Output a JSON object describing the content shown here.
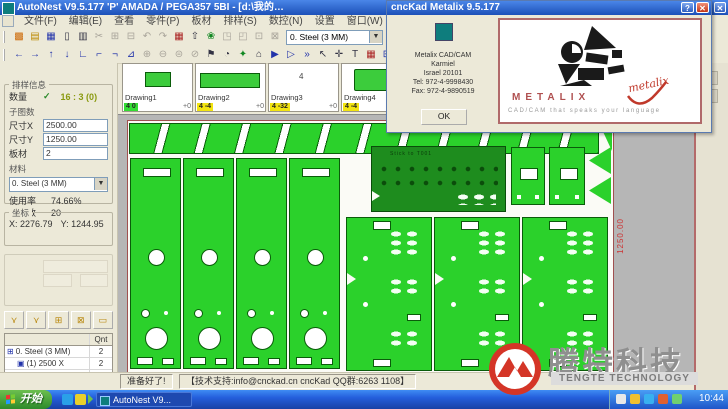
{
  "titlebar": {
    "title": "AutoNest V9.5.177   'P'   AMADA / PEGA357   5BI    - [d:\\我的…",
    "help_btn": "?",
    "close_btn": "✕"
  },
  "menu": {
    "items": [
      "文件(F)",
      "编辑(E)",
      "查看",
      "零件(P)",
      "板材",
      "排样(S)",
      "数控(N)",
      "设置",
      "窗口(W)",
      "帮助(H)"
    ]
  },
  "toolbar1": {
    "icons_a": [
      {
        "g": "▩",
        "c": "or"
      },
      {
        "g": "▤",
        "c": "ye"
      },
      {
        "g": "▦",
        "c": "bl"
      },
      {
        "g": "▯",
        "c": "dk"
      },
      {
        "g": "▥",
        "c": "dk"
      },
      {
        "g": "✂",
        "c": "off"
      },
      {
        "g": "⊞",
        "c": "off"
      },
      {
        "g": "⊟",
        "c": "off"
      },
      {
        "g": "↶",
        "c": "off"
      },
      {
        "g": "↷",
        "c": "off"
      },
      {
        "g": "▦",
        "c": "rd"
      },
      {
        "g": "⇧",
        "c": "dk"
      },
      {
        "g": "❀",
        "c": "gn"
      },
      {
        "g": "◳",
        "c": "off"
      },
      {
        "g": "◰",
        "c": "off"
      },
      {
        "g": "⊡",
        "c": "off"
      },
      {
        "g": "⊠",
        "c": "off"
      }
    ],
    "material_combo": "0. Steel (3 MM)",
    "icons_b": [
      {
        "g": "✓",
        "c": "gn"
      },
      {
        "g": "◉",
        "c": "bl"
      }
    ]
  },
  "toolbar2": {
    "icons": [
      {
        "g": "←",
        "c": "bl"
      },
      {
        "g": "→",
        "c": "bl"
      },
      {
        "g": "↑",
        "c": "bl"
      },
      {
        "g": "↓",
        "c": "bl"
      },
      {
        "g": "∟",
        "c": "bl"
      },
      {
        "g": "⌐",
        "c": "bl"
      },
      {
        "g": "¬",
        "c": "bl"
      },
      {
        "g": "⊿",
        "c": "bl"
      },
      {
        "g": "⊕",
        "c": "off"
      },
      {
        "g": "⊖",
        "c": "off"
      },
      {
        "g": "⊜",
        "c": "off"
      },
      {
        "g": "⊘",
        "c": "off"
      },
      {
        "g": "⚑",
        "c": "dk"
      },
      {
        "g": "◔",
        "c": "dk"
      },
      {
        "g": "✦",
        "c": "gn"
      },
      {
        "g": "⌂",
        "c": "dk"
      },
      {
        "g": "▶",
        "c": "bl"
      },
      {
        "g": "▷",
        "c": "bl"
      },
      {
        "g": "»",
        "c": "bl"
      },
      {
        "g": "↖",
        "c": "dk"
      },
      {
        "g": "✛",
        "c": "dk"
      },
      {
        "g": "T",
        "c": "dk"
      },
      {
        "g": "▦",
        "c": "rd"
      },
      {
        "g": "⊞",
        "c": "bl"
      }
    ]
  },
  "sidebar": {
    "info_group_title": "排样信息",
    "qty_label": "数量",
    "qty_check": "✓",
    "qty_value": "16 : 3  (0)",
    "subdrawings_label": "子图数",
    "size_x_label": "尺寸X",
    "size_x_value": "2500.00",
    "size_y_label": "尺寸Y",
    "size_y_value": "1250.00",
    "sheets_label": "板材",
    "sheets_value": "2",
    "material_label": "材料",
    "material_value": "0. Steel (3 MM)",
    "utilization_label": "使用率",
    "utilization_value": "74.66%",
    "parts_count_label": "零件数",
    "parts_count_value": "20",
    "coords_group_title": "坐标",
    "coord_x_label": "X:",
    "coord_x_value": "2276.79",
    "coord_y_label": "Y:",
    "coord_y_value": "1244.95",
    "nest_buttons": [
      {
        "g": "⋎"
      },
      {
        "g": "⋎"
      },
      {
        "g": "⊞"
      },
      {
        "g": "⊠"
      },
      {
        "g": "▭"
      }
    ],
    "table": {
      "qnt_header": "Qnt",
      "rows": [
        {
          "pre": "⊞",
          "label": "0. Steel (3 MM)",
          "qnt": "2",
          "lvl": "lv0"
        },
        {
          "pre": "▣",
          "label": "(1) 2500 X",
          "qnt": "2",
          "lvl": "lv1"
        },
        {
          "pre": "",
          "label": "Total qnt",
          "qnt": "2",
          "lvl": "lv0"
        }
      ]
    }
  },
  "thumbnails": [
    {
      "name": "Drawing1",
      "prev": "p1",
      "preview_text": "",
      "badge": "4 0",
      "bcls": "bg",
      "extra": "+0"
    },
    {
      "name": "Drawing2",
      "prev": "p2",
      "preview_text": "",
      "badge": "4 -4",
      "bcls": "by",
      "extra": "+0"
    },
    {
      "name": "Drawing3",
      "prev": "p3",
      "preview_text": "4",
      "badge": "4 -32",
      "bcls": "by",
      "extra": "+0"
    },
    {
      "name": "Drawing4",
      "prev": "p4",
      "preview_text": "",
      "badge": "4 -4",
      "bcls": "by",
      "extra": "+0"
    },
    {
      "name": "Group",
      "prev": "p5",
      "preview_text": "",
      "badge": "",
      "bcls": "bg",
      "extra": "+0"
    }
  ],
  "canvas": {
    "height_dim": "1250.00",
    "dark_part_label": "Stick to T001"
  },
  "about": {
    "title": "cncKad Metalix  9.5.177",
    "help_btn": "?",
    "close_btn": "✕",
    "line1": "Metalix CAD/CAM",
    "line2": "Karmiel",
    "line3": "Israel 20101",
    "line4": "Tel: 972-4-9998430",
    "line5": "Fax: 972-4-9890519",
    "ok_label": "OK",
    "brand": "METALIX",
    "tagline": "CAD/CAM that speaks your language",
    "script": "metalix"
  },
  "statusbar": {
    "ready": "准备好了!",
    "support": "【技术支持:info@cnckad.cn   cncKad QQ群:6263 1108】"
  },
  "taskbar": {
    "start_label": "开始",
    "task_label": "AutoNest V9...",
    "clock": "10:44"
  },
  "watermark": {
    "cn": "腾特科技",
    "en": "TENGTE TECHNOLOGY"
  }
}
